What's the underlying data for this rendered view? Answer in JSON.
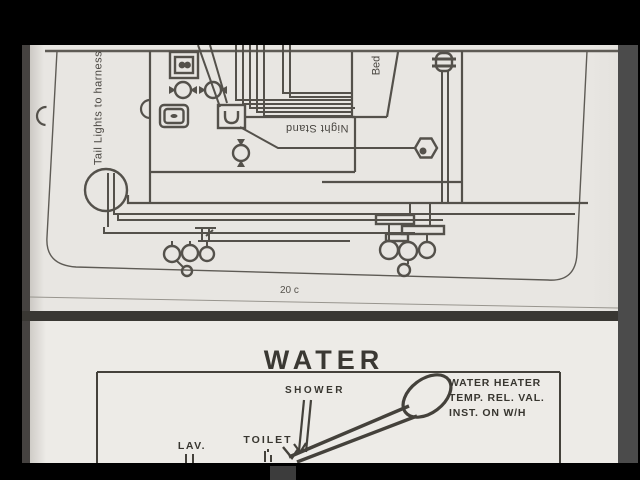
{
  "scan": {
    "top_page": {
      "page_number": "20 c",
      "labels": {
        "tail_lights": "Tail Lights to harness",
        "bed": "Bed",
        "night_stand": "Night Stand"
      }
    },
    "bottom_page": {
      "title": "WATER",
      "labels": {
        "shower": "SHOWER",
        "lav": "LAV.",
        "toilet": "TOILET"
      },
      "water_heater_note": {
        "line1": "WATER HEATER",
        "line2": "TEMP. REL. VAL.",
        "line3": "INST. ON W/H"
      }
    },
    "colors": {
      "background": "#000000",
      "paper_top": "#e8e6e2",
      "paper_bottom": "#edebe7",
      "ink": "#514e48",
      "ink_dark": "#3c3a34",
      "side_strip": "#4b4b4b"
    }
  }
}
